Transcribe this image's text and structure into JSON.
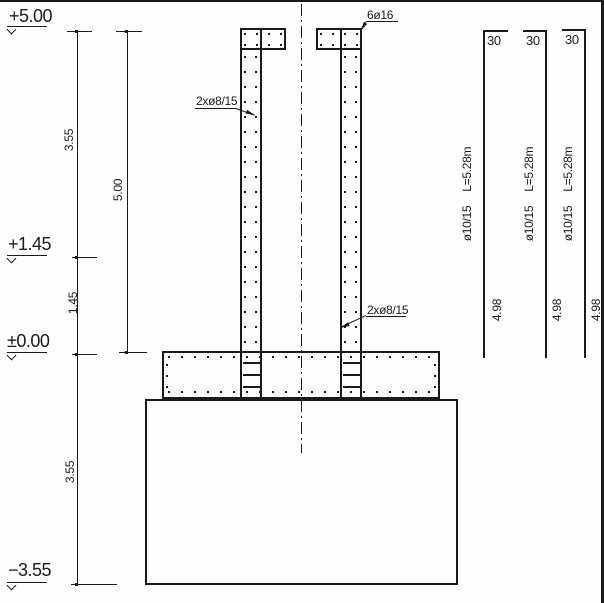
{
  "colors": {
    "ink": "#1a1a1a",
    "paper": "#fefefe"
  },
  "levels": {
    "top": "+5.00",
    "mid": "+1.45",
    "zero": "±0.00",
    "bottom": "−3.55"
  },
  "dims": {
    "seg_top": "3.55",
    "seg_mid": "1.45",
    "seg_bottom": "3.55",
    "wall": "5.00"
  },
  "labels": {
    "top_bars": "6ø16",
    "wall_bars_upper": "2xø8/15",
    "wall_bars_lower": "2xø8/15"
  },
  "schedule": {
    "bars": [
      {
        "hook": "30",
        "spec": "ø10/15",
        "length": "L=5.28m",
        "straight": "4.98"
      },
      {
        "hook": "30",
        "spec": "ø10/15",
        "length": "L=5.28m",
        "straight": "4.98"
      },
      {
        "hook": "30",
        "spec": "ø10/15",
        "length": "L=5.28m",
        "straight": "4.98"
      }
    ]
  }
}
